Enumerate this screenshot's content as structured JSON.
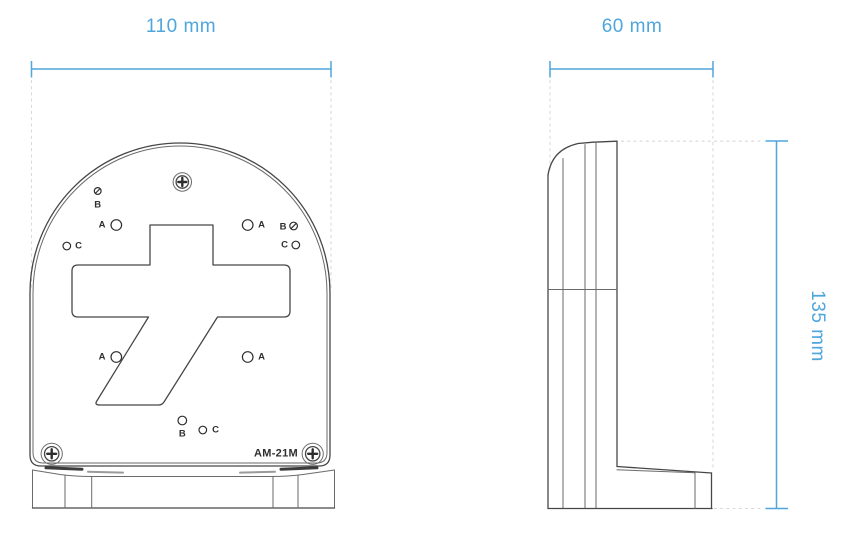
{
  "drawing": {
    "model_label": "AM-21M",
    "dimensions": {
      "front_width": "110 mm",
      "side_depth": "60 mm",
      "side_height": "135 mm"
    },
    "mount_hole_labels": {
      "tl_b": "B",
      "tl_a": "A",
      "left_c": "C",
      "tr_a": "A",
      "tr_b": "B",
      "right_c": "C",
      "ml_a": "A",
      "mr_a": "A",
      "bottom_b": "B",
      "bottom_c": "C"
    },
    "colors": {
      "dimension_blue": "#4FA6DC",
      "line_dark": "#474747",
      "line_mid": "#6a6a6a",
      "extension_gray": "#d9d9d9",
      "label_dark": "#2e2e2e"
    }
  }
}
